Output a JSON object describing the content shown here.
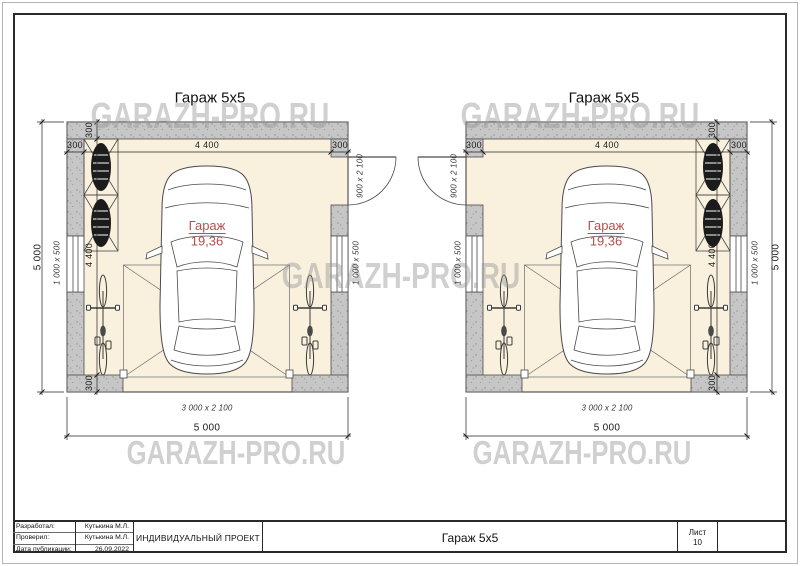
{
  "watermark": {
    "text": "GARAZH-PRO.RU"
  },
  "plan": {
    "title": "Гараж 5х5",
    "room": {
      "name": "Гараж",
      "area": "19,36"
    },
    "dims": {
      "overall": "5 000",
      "inner": "4 400",
      "wall_thickness": "300",
      "window_size": "1 000 x 500",
      "door_size": "900 x 2 100",
      "gate_size": "3 000 x 2 100"
    }
  },
  "title_block": {
    "developed_label": "Разработал:",
    "developed_value": "Кутькина М.Л.",
    "checked_label": "Проверил:",
    "checked_value": "Кутькина М.Л.",
    "date_label": "Дата публикации:",
    "date_value": "26.09.2022",
    "project_type": "ИНДИВИДУАЛЬНЫЙ ПРОЕКТ",
    "project_name": "Гараж 5х5",
    "sheet_label": "Лист",
    "sheet_number": "10"
  },
  "colors": {
    "floor": "#f9f1dd",
    "wall": "#c6c6c6",
    "accent_red": "#b2524d",
    "watermark_gray": "#cfcfcf"
  }
}
